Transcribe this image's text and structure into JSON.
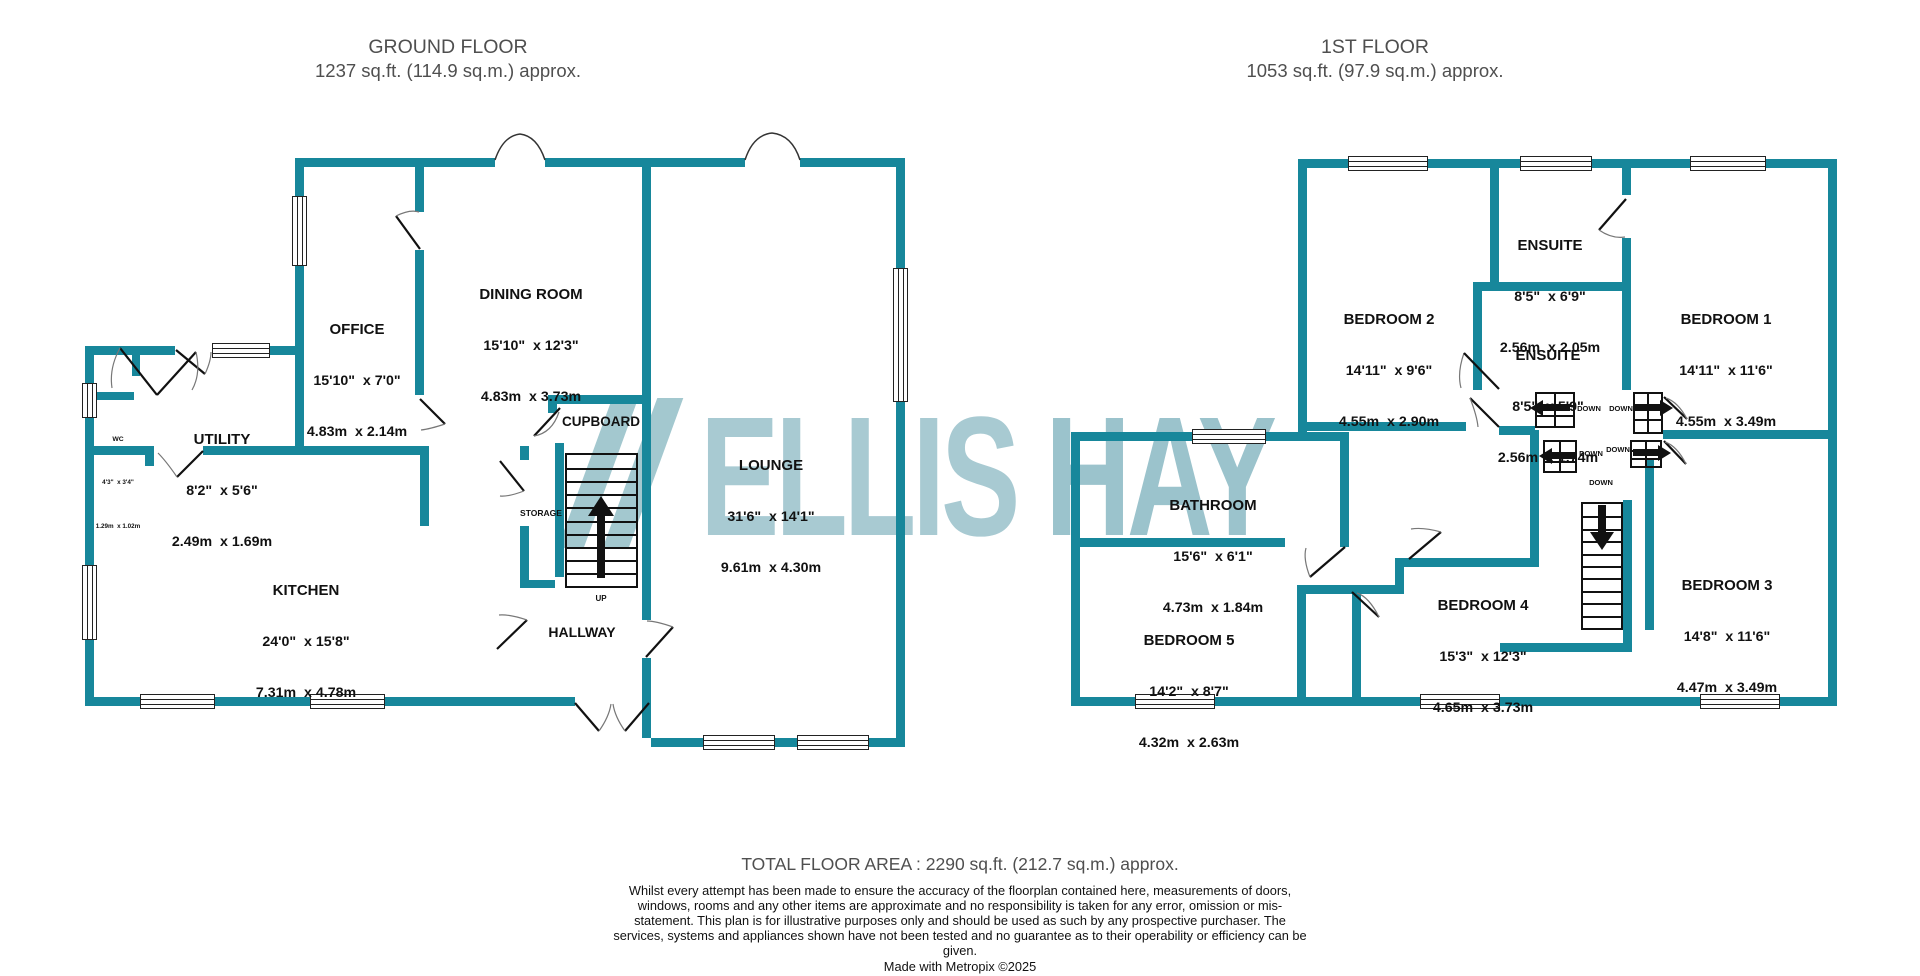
{
  "ground_header": {
    "title": "GROUND FLOOR",
    "area": "1237 sq.ft. (114.9 sq.m.) approx."
  },
  "first_header": {
    "title": "1ST FLOOR",
    "area": "1053 sq.ft. (97.9 sq.m.) approx."
  },
  "watermark": {
    "part1": "ELLIS ",
    "part2": "HAY"
  },
  "colors": {
    "wall_teal": "#17879B",
    "watermark_light": "#A8CAD2"
  },
  "ground_floor": {
    "rooms": [
      {
        "name": "OFFICE",
        "imperial": "15'10\"  x 7'0\"",
        "metric": "4.83m  x 2.14m"
      },
      {
        "name": "DINING ROOM",
        "imperial": "15'10\"  x 12'3\"",
        "metric": "4.83m  x 3.73m"
      },
      {
        "name": "UTILITY",
        "imperial": "8'2\"  x 5'6\"",
        "metric": "2.49m  x 1.69m"
      },
      {
        "name": "WC",
        "imperial": "4'3\"  x 3'4\"",
        "metric": "1.29m  x 1.02m"
      },
      {
        "name": "KITCHEN",
        "imperial": "24'0\"  x 15'8\"",
        "metric": "7.31m  x 4.78m"
      },
      {
        "name": "LOUNGE",
        "imperial": "31'6\"  x 14'1\"",
        "metric": "9.61m  x 4.30m"
      }
    ],
    "labels": {
      "cupboard": "CUPBOARD",
      "storage": "STORAGE",
      "hallway": "HALLWAY",
      "up": "UP"
    }
  },
  "first_floor": {
    "rooms": [
      {
        "name": "BEDROOM 2",
        "imperial": "14'11\"  x 9'6\"",
        "metric": "4.55m  x 2.90m"
      },
      {
        "name": "ENSUITE",
        "imperial": "8'5\"  x 6'9\"",
        "metric": "2.56m  x 2.05m"
      },
      {
        "name": "ENSUITE",
        "imperial": "8'5\"  x 5'9\"",
        "metric": "2.56m  x 1.74m"
      },
      {
        "name": "BEDROOM 1",
        "imperial": "14'11\"  x 11'6\"",
        "metric": "4.55m  x 3.49m"
      },
      {
        "name": "BATHROOM",
        "imperial": "15'6\"  x 6'1\"",
        "metric": "4.73m  x 1.84m"
      },
      {
        "name": "BEDROOM 5",
        "imperial": "14'2\"  x 8'7\"",
        "metric": "4.32m  x 2.63m"
      },
      {
        "name": "BEDROOM 4",
        "imperial": "15'3\"  x 12'3\"",
        "metric": "4.65m  x 3.73m"
      },
      {
        "name": "BEDROOM 3",
        "imperial": "14'8\"  x 11'6\"",
        "metric": "4.47m  x 3.49m"
      }
    ],
    "labels": {
      "down": "DOWN"
    }
  },
  "footer": {
    "total": "TOTAL FLOOR AREA : 2290 sq.ft. (212.7 sq.m.) approx.",
    "disclaimer": "Whilst every attempt has been made to ensure the accuracy of the floorplan contained here, measurements of doors, windows, rooms and any other items are approximate and no responsibility is taken for any error, omission or mis-statement. This plan is for illustrative purposes only and should be used as such by any prospective purchaser. The services, systems and appliances shown have not been tested and no guarantee as to their operability or efficiency can be given.",
    "credit": "Made with Metropix ©2025"
  }
}
